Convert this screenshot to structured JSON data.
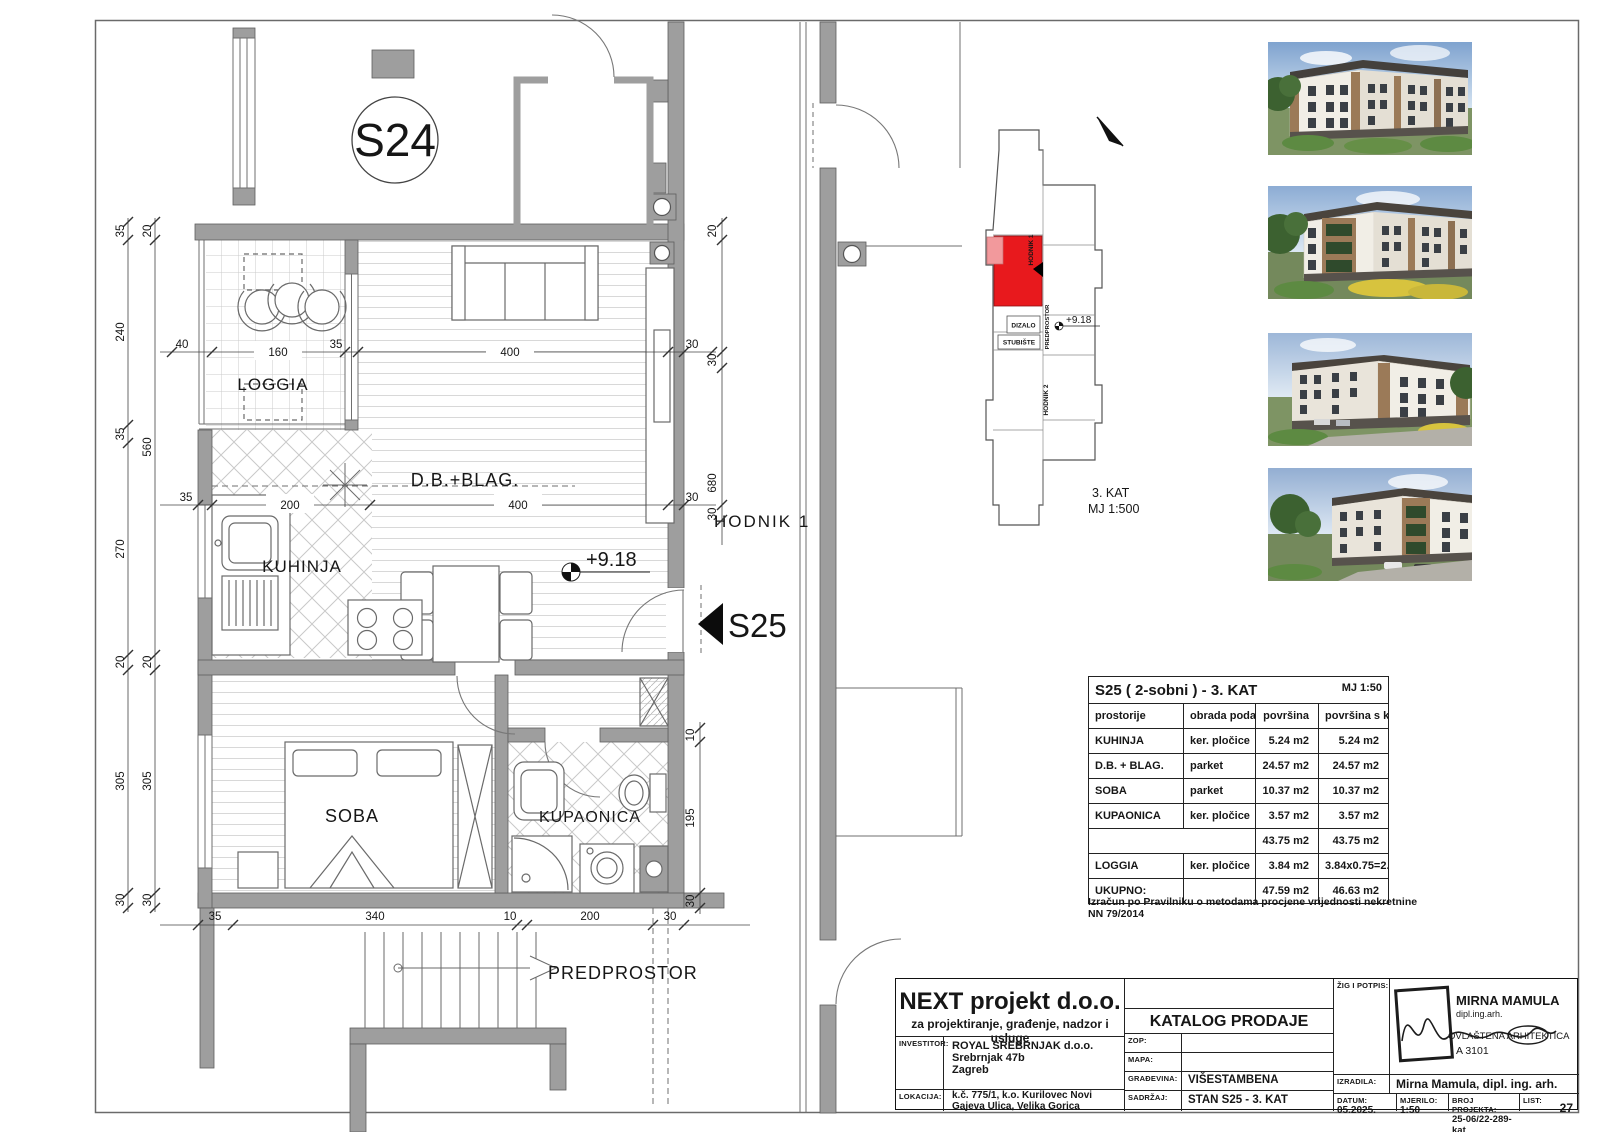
{
  "plan": {
    "unit_label": "S24",
    "unit_pointer": "S25",
    "elevation": "+9.18",
    "rooms": {
      "loggia": "LOGGIA",
      "living": "D.B.+BLAG.",
      "kitchen": "KUHINJA",
      "bedroom": "SOBA",
      "bathroom": "KUPAONICA",
      "corridor": "HODNIK  1",
      "hall": "PREDPROSTOR"
    },
    "dims": {
      "left_outer": [
        "35",
        "240",
        "35",
        "270",
        "20",
        "305",
        "30"
      ],
      "left_inner": [
        "20",
        "560",
        "20",
        "305",
        "30"
      ],
      "top_chain": [
        "40",
        "160",
        "35",
        "400",
        "30"
      ],
      "mid_chain": [
        "35",
        "200",
        "400",
        "30"
      ],
      "right_chain": [
        "20",
        "30",
        "680",
        "30"
      ],
      "right_lower": [
        "10",
        "195",
        "30"
      ],
      "bottom_chain": [
        "35",
        "340",
        "10",
        "200",
        "30"
      ]
    }
  },
  "keyplan": {
    "hodnik1": "HODNIK 1",
    "dizalo": "DIZALO",
    "stubiste": "STUBIŠTE",
    "predprostor": "PREDPROSTOR",
    "hodnik2": "HODNIK 2",
    "elevation": "+9.18",
    "floor": "3. KAT",
    "scale": "MJ 1:500",
    "highlight_color": "#e8191d"
  },
  "table": {
    "title": "S25 ( 2-sobni ) - 3. KAT",
    "scale": "MJ 1:50",
    "headers": [
      "prostorije",
      "obrada poda",
      "površina",
      "površina s koef."
    ],
    "rows": [
      [
        "KUHINJA",
        "ker. pločice",
        "5.24 m2",
        "5.24 m2"
      ],
      [
        "D.B. + BLAG.",
        "parket",
        "24.57 m2",
        "24.57 m2"
      ],
      [
        "SOBA",
        "parket",
        "10.37 m2",
        "10.37 m2"
      ],
      [
        "KUPAONICA",
        "ker. pločice",
        "3.57 m2",
        "3.57 m2"
      ],
      [
        "",
        "",
        "43.75 m2",
        "43.75 m2"
      ],
      [
        "LOGGIA",
        "ker. pločice",
        "3.84 m2",
        "3.84x0.75=2.88 m2"
      ],
      [
        "UKUPNO:",
        "",
        "47.59 m2",
        "46.63 m2"
      ]
    ],
    "note": "Izračun po Pravilniku o metodama procjene vrijednosti nekretnine  NN 79/2014"
  },
  "titleblock": {
    "company": "NEXT projekt d.o.o.",
    "company_sub": "za projektiranje, građenje, nadzor i usluge",
    "investor_label": "INVESTITOR:",
    "investor_lines": [
      "ROYAL SREBRNJAK d.o.o.",
      "Srebrnjak 47b",
      "Zagreb"
    ],
    "location_label": "LOKACIJA:",
    "location_lines": [
      "k.č. 775/1, k.o. Kurilovec Novi",
      "Gajeva Ulica, Velika Gorica"
    ],
    "catalog": "KATALOG PRODAJE",
    "zop_label": "ZOP:",
    "mapa_label": "MAPA:",
    "building_label": "GRAĐEVINA:",
    "building": "VIŠESTAMBENA",
    "content_label": "SADRŽAJ:",
    "content": "STAN S25 - 3. KAT",
    "stamp_label": "ŽIG I POTPIS:",
    "made_by_label": "IZRADILA:",
    "made_by": "Mirna Mamula, dipl. ing. arh.",
    "date_label": "DATUM:",
    "date": "05.2025.",
    "scale_label": "MJERILO:",
    "scale": "1:50",
    "project_no_label": "BROJ PROJEKTA:",
    "project_no": "25-06/22-289-kat",
    "sheet_label": "LIST:",
    "sheet": "27",
    "stamp": {
      "name": "MIRNA MAMULA",
      "title": "dipl.ing.arh.",
      "license": "OVLAŠTENA ARHITEKTICA",
      "number": "A 3101"
    }
  }
}
